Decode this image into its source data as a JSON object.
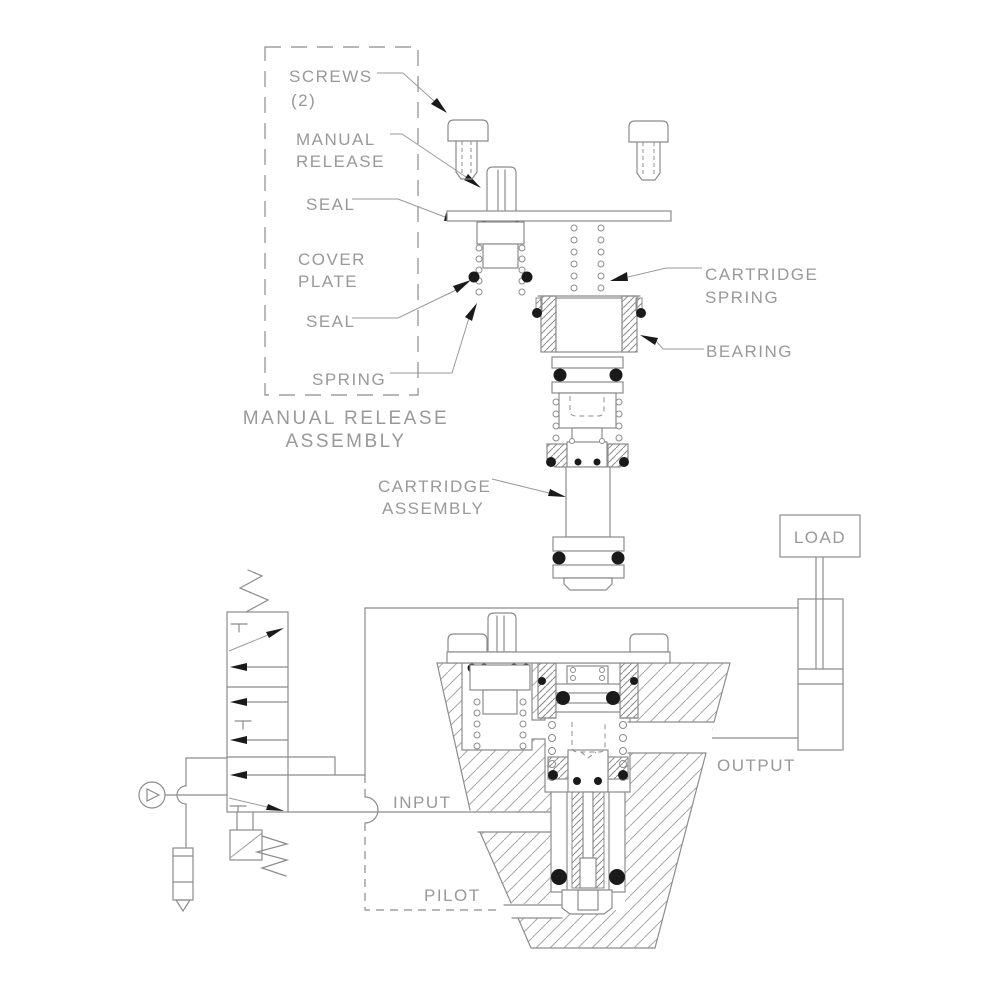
{
  "diagram": {
    "exploded": {
      "screws_1": "SCREWS",
      "screws_2": "(2)",
      "manual_1": "MANUAL",
      "manual_2": "RELEASE",
      "seal_upper": "SEAL",
      "cover_1": "COVER",
      "cover_2": "PLATE",
      "seal_lower": "SEAL",
      "spring": "SPRING",
      "caption_1": "MANUAL RELEASE",
      "caption_2": "ASSEMBLY",
      "cartridge_spring_1": "CARTRIDGE",
      "cartridge_spring_2": "SPRING",
      "bearing": "BEARING",
      "cartridge_assembly_1": "CARTRIDGE",
      "cartridge_assembly_2": "ASSEMBLY"
    },
    "section": {
      "load": "LOAD",
      "output": "OUTPUT",
      "input": "INPUT",
      "pilot": "PILOT"
    },
    "colors": {
      "line": "#8c8c8c",
      "text": "#999999",
      "ink": "#1a1a1a",
      "background": "#ffffff"
    }
  }
}
